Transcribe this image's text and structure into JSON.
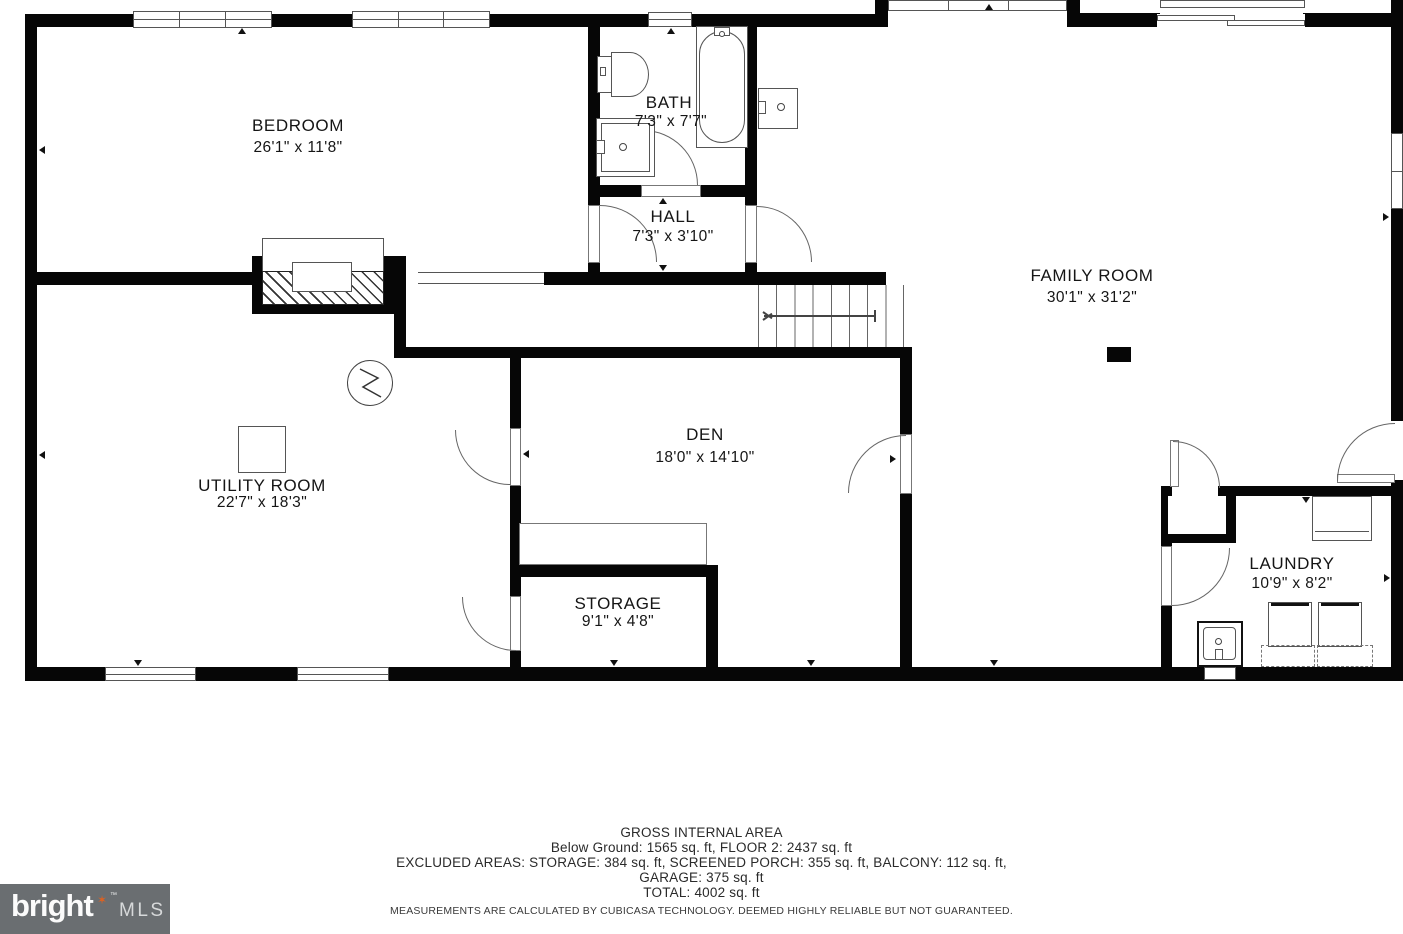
{
  "plan": {
    "rooms": [
      {
        "id": "bedroom",
        "name": "BEDROOM",
        "dims": "26'1\" x 11'8\""
      },
      {
        "id": "bath",
        "name": "BATH",
        "dims": "7'3\" x 7'7\""
      },
      {
        "id": "hall",
        "name": "HALL",
        "dims": "7'3\" x 3'10\""
      },
      {
        "id": "family-room",
        "name": "FAMILY ROOM",
        "dims": "30'1\" x 31'2\""
      },
      {
        "id": "utility-room",
        "name": "UTILITY ROOM",
        "dims": "22'7\" x 18'3\""
      },
      {
        "id": "den",
        "name": "DEN",
        "dims": "18'0\" x 14'10\""
      },
      {
        "id": "storage",
        "name": "STORAGE",
        "dims": "9'1\" x 4'8\""
      },
      {
        "id": "laundry",
        "name": "LAUNDRY",
        "dims": "10'9\" x 8'2\""
      }
    ],
    "fixtures": [
      "fireplace",
      "toilet",
      "bathtub",
      "bath-vanity-sink",
      "wet-bar-sink",
      "water-heater",
      "sump-symbol",
      "staircase",
      "washer",
      "dryer",
      "laundry-sink",
      "closet",
      "cabinet",
      "support-column"
    ]
  },
  "footer": {
    "title": "GROSS INTERNAL AREA",
    "line1": "Below Ground: 1565 sq. ft, FLOOR 2: 2437 sq. ft",
    "line2": "EXCLUDED AREAS: STORAGE: 384 sq. ft, SCREENED PORCH: 355 sq. ft, BALCONY: 112 sq. ft,",
    "line3": "GARAGE: 375 sq. ft",
    "line4": "TOTAL: 4002 sq. ft",
    "disclaimer": "MEASUREMENTS ARE CALCULATED BY CUBICASA TECHNOLOGY. DEEMED HIGHLY RELIABLE BUT NOT GUARANTEED."
  },
  "logo": {
    "brand": "bright",
    "star": "✶",
    "tm": "™",
    "suffix": "MLS",
    "bg": "#6a6e71",
    "star_color": "#e0611f"
  },
  "colors": {
    "wall": "#060606",
    "thin_line": "#555555",
    "text": "#1c1c1c"
  }
}
